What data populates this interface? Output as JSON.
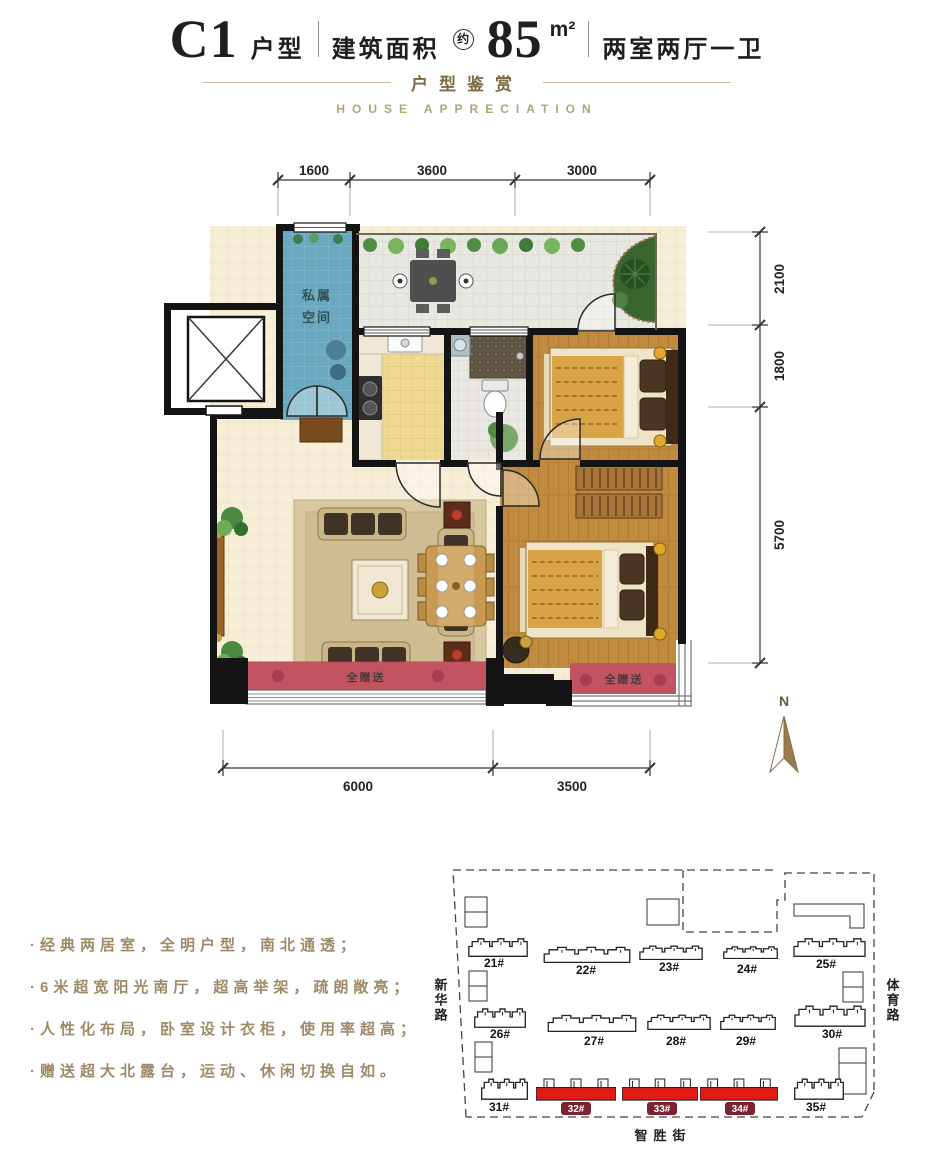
{
  "header": {
    "unit_code": "C1",
    "unit_type_label": "户型",
    "area_label": "建筑面积",
    "area_approx": "约",
    "area_value": "85",
    "area_unit": "m²",
    "layout_label": "两室两厅一卫"
  },
  "subtitle": {
    "cn": "户型鉴赏",
    "en": "HOUSE APPRECIATION"
  },
  "floor_plan": {
    "dims": {
      "top": [
        "1600",
        "3600",
        "3000"
      ],
      "right": [
        "2100",
        "1800",
        "5700"
      ],
      "bottom": [
        "6000",
        "3500"
      ]
    },
    "labels": {
      "private_space": [
        "私属",
        "空间"
      ],
      "gift_south": "全赠送",
      "gift_east": "全赠送",
      "north": "N"
    }
  },
  "features": {
    "items": [
      "·经典两居室，全明户型，南北通透；",
      "·6米超宽阳光南厅，超高举架，疏朗敞亮；",
      "·人性化布局，卧室设计衣柜，使用率超高；",
      "·赠送超大北露台，运动、休闲切换自如。"
    ]
  },
  "site_map": {
    "streets": {
      "west": "新华路",
      "east": "体育路",
      "south": "智胜街"
    },
    "buildings": [
      {
        "label": "21#",
        "highlighted": false
      },
      {
        "label": "22#",
        "highlighted": false
      },
      {
        "label": "23#",
        "highlighted": false
      },
      {
        "label": "24#",
        "highlighted": false
      },
      {
        "label": "25#",
        "highlighted": false
      },
      {
        "label": "26#",
        "highlighted": false
      },
      {
        "label": "27#",
        "highlighted": false
      },
      {
        "label": "28#",
        "highlighted": false
      },
      {
        "label": "29#",
        "highlighted": false
      },
      {
        "label": "30#",
        "highlighted": false
      },
      {
        "label": "31#",
        "highlighted": false
      },
      {
        "label": "32#",
        "highlighted": true
      },
      {
        "label": "33#",
        "highlighted": true
      },
      {
        "label": "34#",
        "highlighted": true
      },
      {
        "label": "35#",
        "highlighted": false
      }
    ]
  },
  "colors": {
    "highlight_red": "#e31b17",
    "badge_maroon": "#7d2231",
    "balcony_red": "#c25462",
    "north_arrow_brown": "#9a7b4e",
    "feature_text_tan": "#9f8a68",
    "subtitle_gold": "#7d6b45"
  }
}
